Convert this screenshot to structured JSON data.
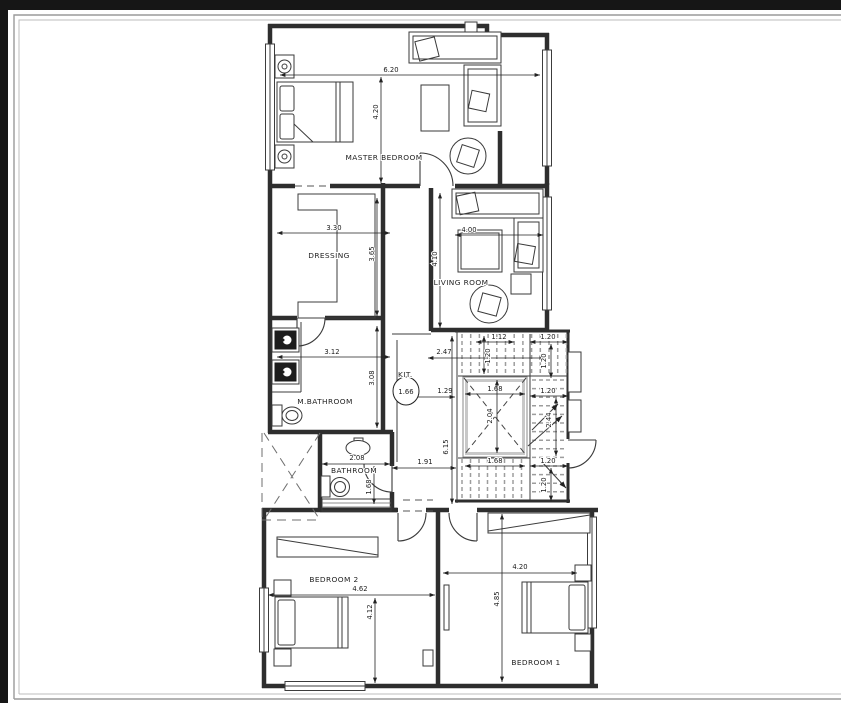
{
  "window": {
    "top_bar_color": "#161616",
    "side_bar_color": "#161616",
    "frame_color": "#9a9a9a",
    "page_bg": "#ffffff",
    "ink_color": "#2e2e2e",
    "hatch_color": "#9d9d9d"
  },
  "plan": {
    "rooms": {
      "master": "MASTER BEDROOM",
      "dressing": "DRESSING",
      "living": "LIVING ROOM",
      "mbath": "M.BATHROOM",
      "kitchen": "KIT.",
      "bath": "BATHROOM",
      "bed2": "BEDROOM 2",
      "bed1": "BEDROOM 1"
    },
    "dims": {
      "master_w": "6.20",
      "master_h": "4.20",
      "dressing_w": "3.30",
      "dressing_h": "3.65",
      "living_w": "4.00",
      "living_h": "4.10",
      "mbath_w": "3.12",
      "mbath_h": "3.08",
      "hall_top": "2.47",
      "hall_mid": "1.29",
      "kit_bubble": "1.66",
      "hall_len": "6.15",
      "hall_bottom": "1.91",
      "bath_w": "2.08",
      "bath_h": "1.68",
      "stair_top": "1.12",
      "tread": "1.20",
      "void_w": "1.68",
      "void_h": "2.04",
      "flight": "2.44",
      "bed2_w": "4.62",
      "bed2_h": "4.12",
      "bed1_w": "4.20",
      "bed1_h": "4.85"
    }
  }
}
